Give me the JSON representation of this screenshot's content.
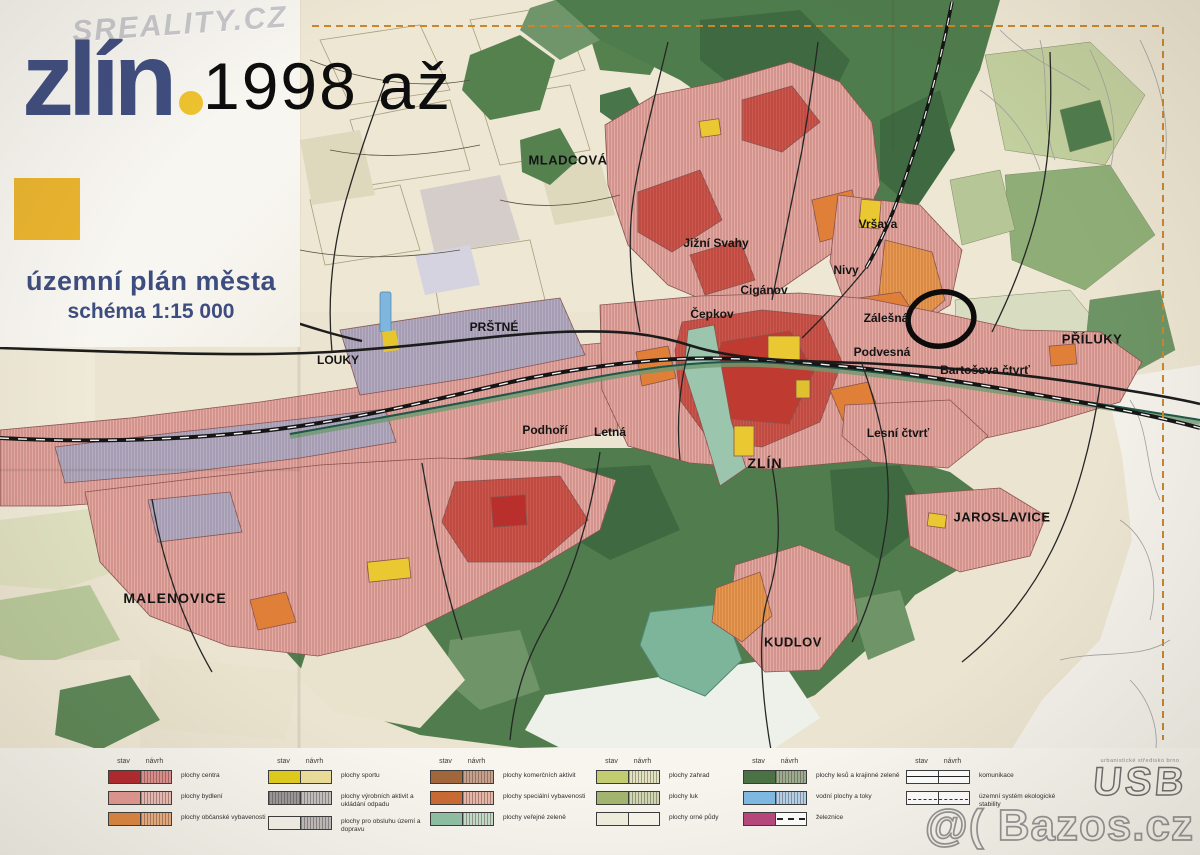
{
  "watermarks": {
    "sreality": "SREALITY.CZ",
    "bazos": "@( Bazos.cz"
  },
  "annotation": {
    "year_note": "1998 až"
  },
  "header": {
    "logo": "zlín",
    "title": "územní plán města",
    "subtitle": "schéma 1:15 000"
  },
  "map": {
    "labels": {
      "mladcova": "MLADCOVÁ",
      "jizni_svahy": "Jižní Svahy",
      "vrsava": "Vršava",
      "nivy": "Nivy",
      "ciganov": "Cigánov",
      "cepkov": "Čepkov",
      "prstne": "PRŠTNÉ",
      "louky": "LOUKY",
      "zalesna": "Zálešná",
      "podvesna": "Podvesná",
      "bartosova": "Bartošova čtvrť",
      "priluky": "PŘÍLUKY",
      "podhori": "Podhoří",
      "letna": "Letná",
      "zlin": "ZLÍN",
      "lesni_ctvrt": "Lesní čtvrť",
      "jaroslavice": "JAROSLAVICE",
      "malenovice": "MALENOVICE",
      "kudlov": "KUDLOV"
    },
    "highlight_circle_color": "#0c0c0c"
  },
  "legend": {
    "stav_label": "stav",
    "navrh_label": "návrh",
    "columns": [
      {
        "items": [
          {
            "label": "plochy centra",
            "stav": "#b4282e",
            "navrh": "#e2928e"
          },
          {
            "label": "plochy bydlení",
            "stav": "#e59a94",
            "navrh": "#efc0b8"
          },
          {
            "label": "plochy občanské vybavenosti",
            "stav": "#e0873f",
            "navrh": "#eeb183"
          }
        ]
      },
      {
        "items": [
          {
            "label": "plochy sportu",
            "stav": "#e2cd1c",
            "navrh": "#ecdf9b"
          },
          {
            "label": "plochy výrobních aktivit a ukládání odpadu",
            "stav": "#9a9a9a",
            "navrh": "#c2c2c2"
          },
          {
            "label": "plochy pro obsluhu území a dopravu",
            "stav": "#f5f3ea",
            "navrh": "#bdbdbd"
          }
        ]
      },
      {
        "items": [
          {
            "label": "plochy komerčních aktivit",
            "stav": "#a2663c",
            "navrh": "#c7a18b"
          },
          {
            "label": "plochy speciální vybavenosti",
            "stav": "#c96a33",
            "navrh": "#e8b7a7"
          },
          {
            "label": "plochy veřejné zeleně",
            "stav": "#8fc0a4",
            "navrh": "#c4ddca"
          }
        ]
      },
      {
        "items": [
          {
            "label": "plochy zahrad",
            "stav": "#c3cc70",
            "navrh": "#e0e4bf"
          },
          {
            "label": "plochy luk",
            "stav": "#a2b56f",
            "navrh": "#cfd8b0"
          },
          {
            "label": "plochy orné půdy",
            "stav": "#f0eedd",
            "navrh": "#f7f5eb"
          }
        ]
      },
      {
        "items": [
          {
            "label": "plochy lesů a krajinné zeleně",
            "stav": "#4a7245",
            "navrh": "#9cad90"
          },
          {
            "label": "vodní plochy a toky",
            "stav": "#7fbae4",
            "navrh": "#b3d3ec"
          },
          {
            "label": "železnice",
            "stav": "#b8487c",
            "navrh": "#ffffff"
          }
        ]
      },
      {
        "items": [
          {
            "label": "komunikace",
            "stav": "#ffffff",
            "navrh": "#ffffff"
          },
          {
            "label": "územní systém ekologické stability",
            "stav": "#ffffff",
            "navrh": "#ffffff"
          }
        ]
      }
    ]
  },
  "publisher": {
    "logo": "USB",
    "tagline": "urbanistické středisko brno"
  }
}
